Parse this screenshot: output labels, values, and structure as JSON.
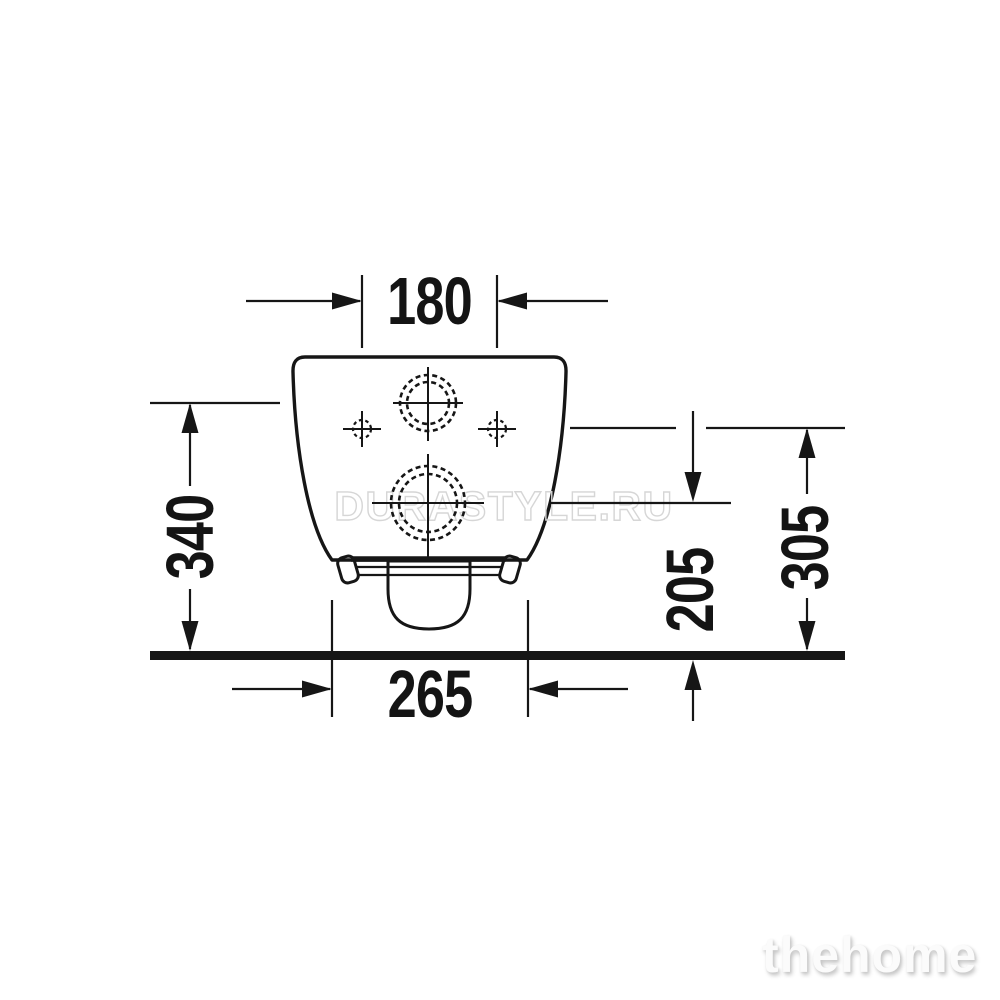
{
  "drawing": {
    "kind": "technical dimension drawing, wall-hung toilet rear view",
    "dimensions": {
      "mount_hole_spacing": "180",
      "inlet_center_height": "340",
      "outlet_center_height": "205",
      "mount_hole_height": "305",
      "base_width": "265"
    },
    "watermark": "DURASTYLE.RU",
    "brand": "thehome",
    "colors": {
      "line": "#161616",
      "watermark_outline": "#d6d6d6",
      "brand_text": "#fbfbfb",
      "background": "#ffffff"
    }
  }
}
